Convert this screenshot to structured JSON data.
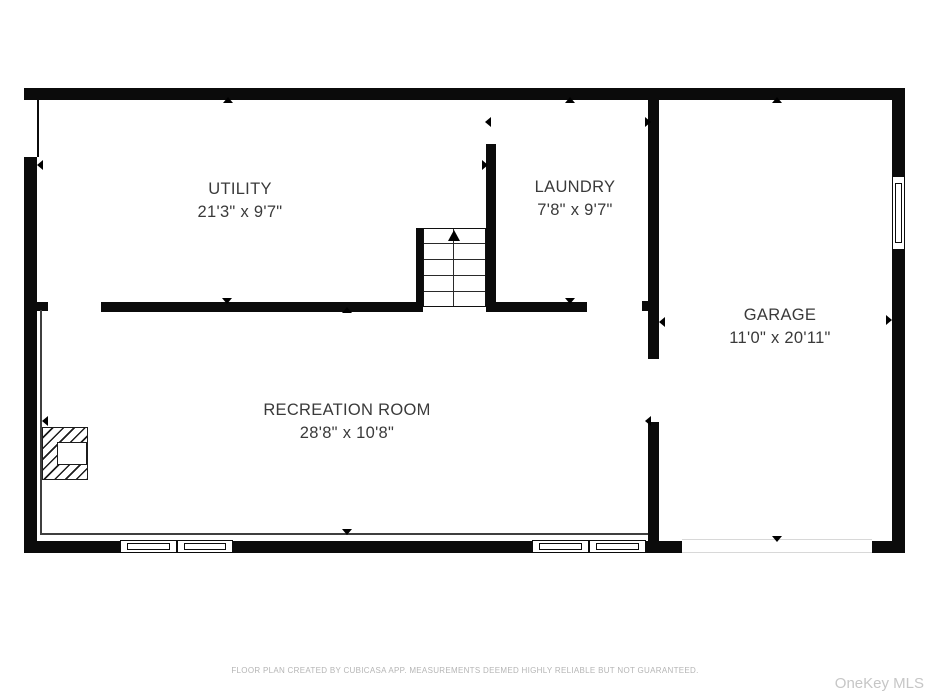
{
  "floor_plan": {
    "rooms": [
      {
        "name": "UTILITY",
        "dimensions": "21'3\" x 9'7\""
      },
      {
        "name": "LAUNDRY",
        "dimensions": "7'8\" x 9'7\""
      },
      {
        "name": "GARAGE",
        "dimensions": "11'0\" x 20'11\""
      },
      {
        "name": "RECREATION ROOM",
        "dimensions": "28'8\" x 10'8\""
      }
    ],
    "stairs": {
      "direction": "up"
    },
    "markers": [
      {
        "x": 228,
        "y": 100,
        "dir": "up"
      },
      {
        "x": 570,
        "y": 100,
        "dir": "up"
      },
      {
        "x": 777,
        "y": 100,
        "dir": "up"
      },
      {
        "x": 347,
        "y": 310,
        "dir": "up"
      },
      {
        "x": 227,
        "y": 301,
        "dir": "down"
      },
      {
        "x": 570,
        "y": 301,
        "dir": "down"
      },
      {
        "x": 347,
        "y": 532,
        "dir": "down"
      },
      {
        "x": 777,
        "y": 539,
        "dir": "down"
      },
      {
        "x": 40,
        "y": 165,
        "dir": "left"
      },
      {
        "x": 488,
        "y": 122,
        "dir": "left"
      },
      {
        "x": 662,
        "y": 322,
        "dir": "left"
      },
      {
        "x": 648,
        "y": 421,
        "dir": "left"
      },
      {
        "x": 45,
        "y": 421,
        "dir": "left"
      },
      {
        "x": 485,
        "y": 165,
        "dir": "right"
      },
      {
        "x": 648,
        "y": 122,
        "dir": "right"
      },
      {
        "x": 889,
        "y": 320,
        "dir": "right"
      }
    ],
    "colors": {
      "wall": "#0b0b0b",
      "label": "#3a3a3a",
      "footer": "#b5b5b5",
      "watermark": "#c6c6c6"
    }
  },
  "footer": {
    "disclaimer": "FLOOR PLAN CREATED BY CUBICASA APP. MEASUREMENTS DEEMED HIGHLY RELIABLE BUT NOT GUARANTEED."
  },
  "watermark": {
    "text": "OneKey MLS"
  }
}
